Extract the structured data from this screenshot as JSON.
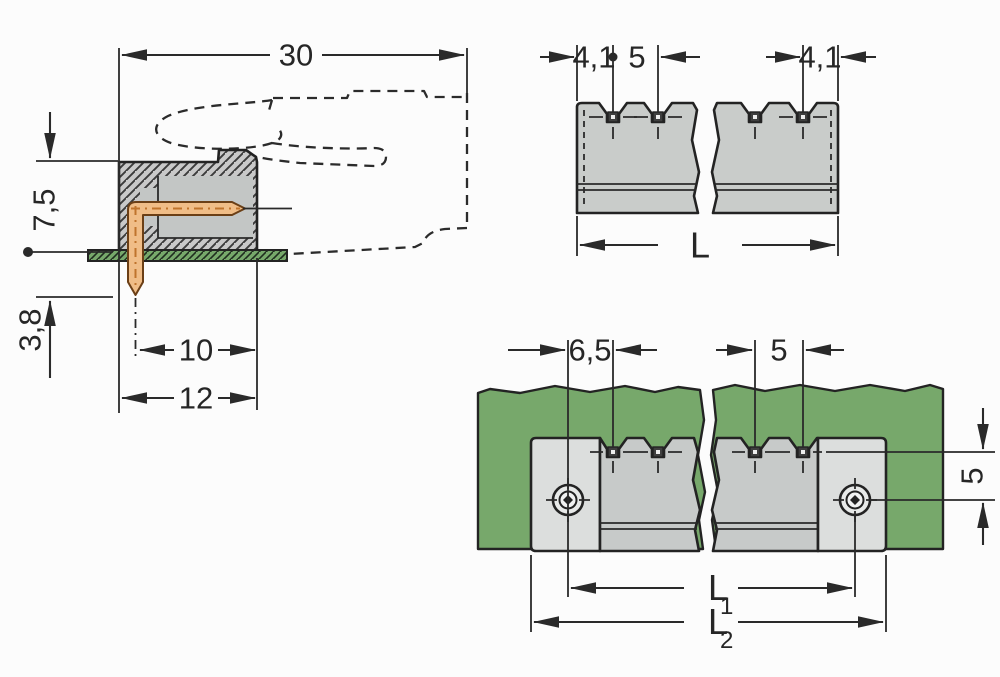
{
  "title": "Male header connector dimensional drawing",
  "colors": {
    "pcb_green": "#77a86b",
    "body_gray": "#c9ccca",
    "flange_gray": "#dcdedd",
    "housing_gray": "#c9c9c9",
    "pin_copper": "#f0bd87",
    "line": "#2a2a2a"
  },
  "side_view": {
    "overall_depth": "30",
    "height_above_board": "7,5",
    "pin_length_below_board": "3,8",
    "pin_to_front_face": "10",
    "body_depth": "12"
  },
  "top_view": {
    "edge_to_pin_left": "4,1",
    "pin_pitch": "5",
    "edge_to_pin_right": "4,1",
    "total_length": "L"
  },
  "pcb_view": {
    "hole_to_first_pin": "6,5",
    "pin_pitch": "5",
    "pin_row_to_hole": "5",
    "hole_spacing": {
      "label": "L",
      "sub": "1"
    },
    "overall_length": {
      "label": "L",
      "sub": "2"
    }
  }
}
